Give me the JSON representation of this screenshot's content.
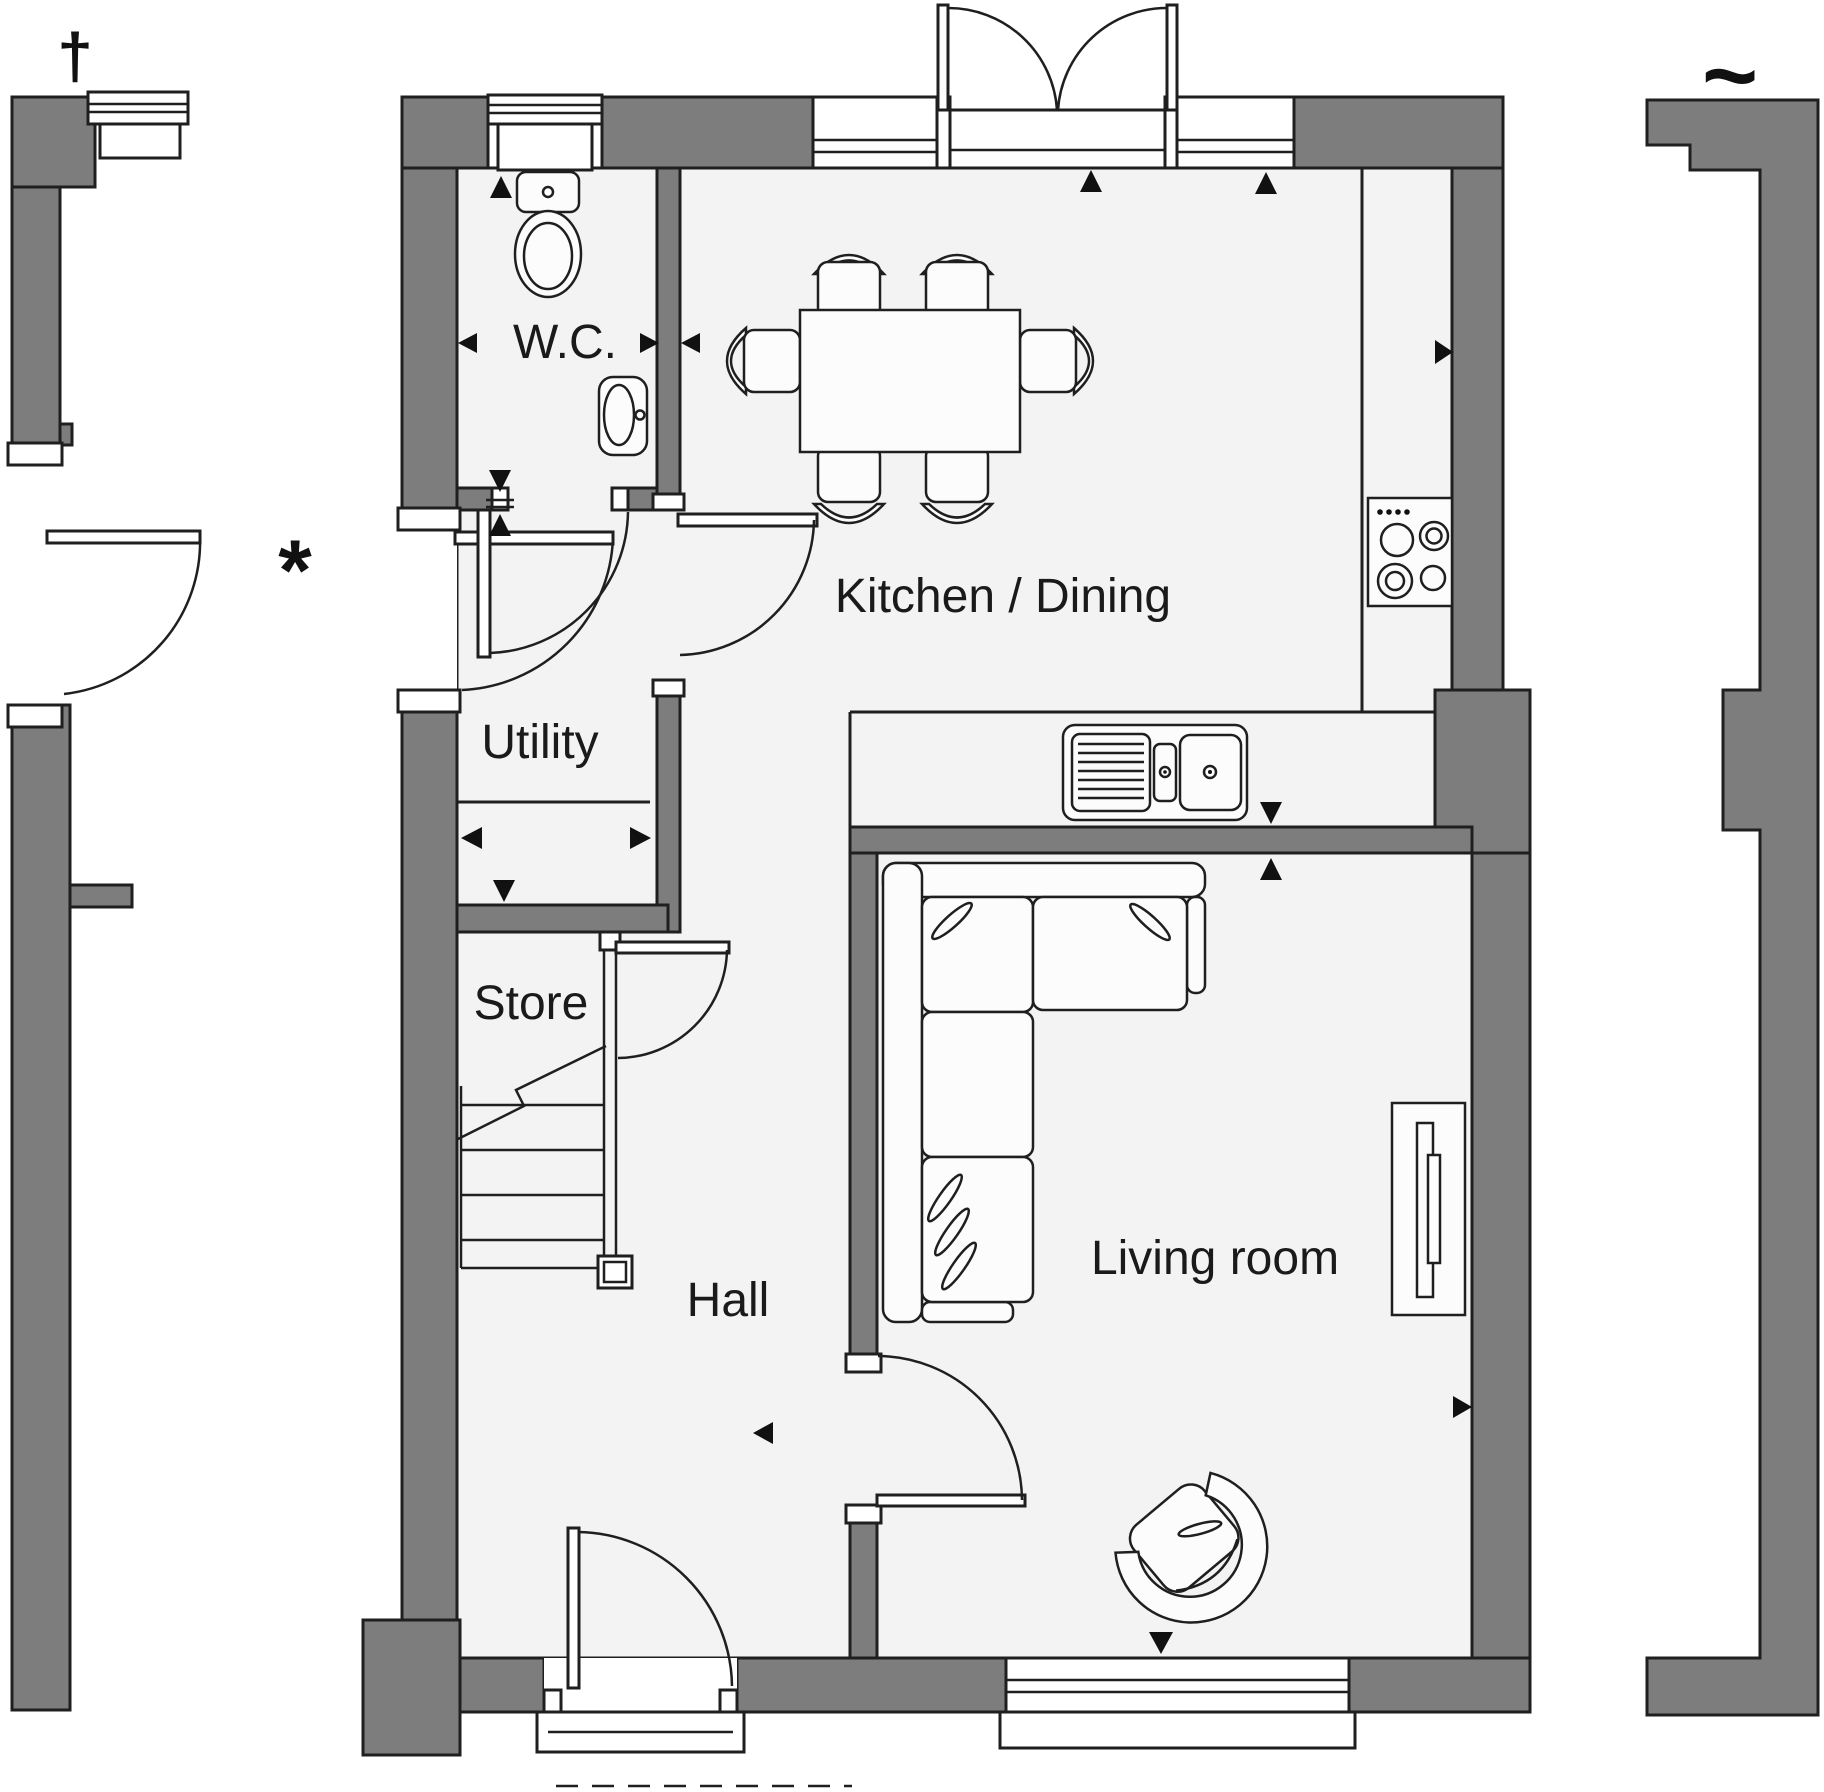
{
  "plan": {
    "rooms": [
      {
        "id": "wc",
        "label": "W.C."
      },
      {
        "id": "kitchen_dining",
        "label": "Kitchen / Dining"
      },
      {
        "id": "utility",
        "label": "Utility"
      },
      {
        "id": "store",
        "label": "Store"
      },
      {
        "id": "hall",
        "label": "Hall"
      },
      {
        "id": "living_room",
        "label": "Living room"
      }
    ],
    "symbols": {
      "dagger": "†",
      "tilde": "~",
      "asterisk": "*"
    },
    "colors": {
      "wall": "#7d7d7d",
      "floor": "#f3f3f3",
      "outline": "#1f1f1f",
      "fixture_fill": "#fcfcfc",
      "background": "#ffffff"
    },
    "fixtures": [
      "toilet",
      "wash-basin",
      "dining-table",
      "dining-chair",
      "hob",
      "double-sink",
      "staircase",
      "corner-sofa",
      "tv-unit",
      "armchair",
      "window",
      "door-swing"
    ]
  }
}
